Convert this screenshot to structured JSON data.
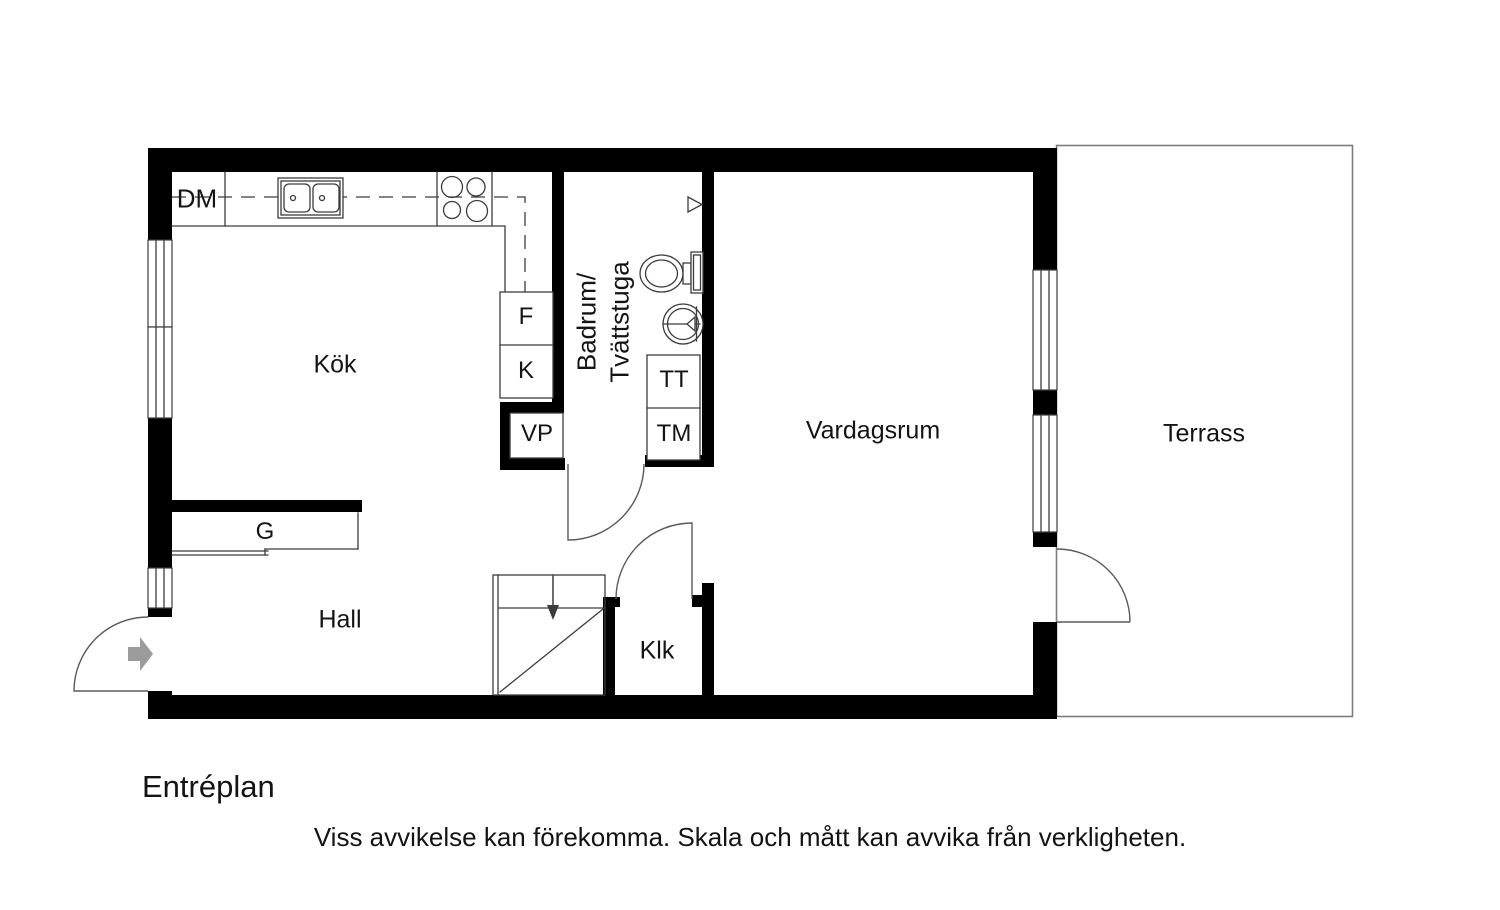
{
  "floor_plan": {
    "title": "Entréplan",
    "disclaimer": "Viss avvikelse kan förekomma. Skala och mått kan avvika från verkligheten.",
    "rooms": {
      "kitchen": "Kök",
      "hall": "Hall",
      "living_room": "Vardagsrum",
      "terrace": "Terrass",
      "closet": "Klk",
      "bathroom_line1": "Badrum/",
      "bathroom_line2": "Tvättstuga"
    },
    "labels": {
      "dishwasher": "DM",
      "freezer": "F",
      "fridge": "K",
      "water_heater": "VP",
      "dryer": "TT",
      "washing_machine": "TM",
      "wardrobe": "G"
    },
    "colors": {
      "wall": "#000000",
      "line": "#3c3c3c",
      "door": "#5a5a5a",
      "terrace_border": "#7c7c7c",
      "arrow": "#9b9b9b",
      "text": "#141414"
    }
  }
}
